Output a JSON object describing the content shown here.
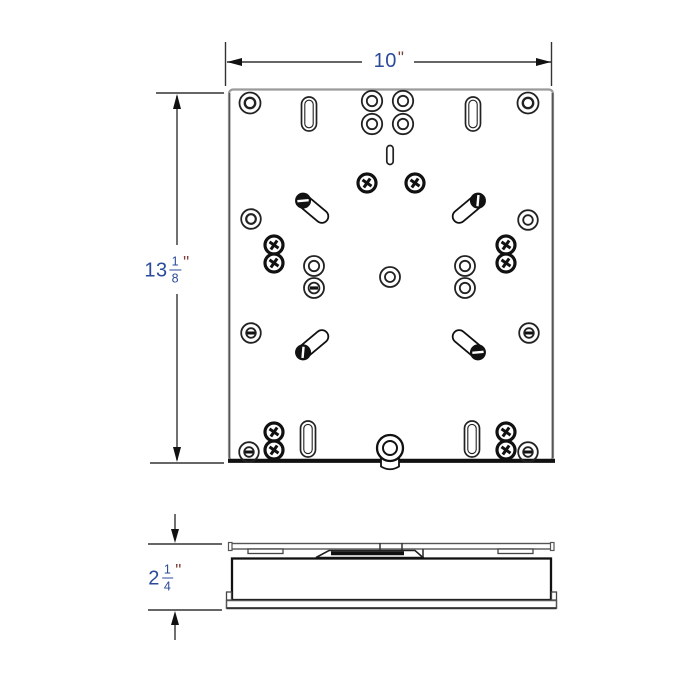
{
  "drawing": {
    "type": "technical-dimension-drawing",
    "subject": "flat mounting plate shown in top view and side profile view",
    "dimensions": {
      "width": {
        "value": "10",
        "unit": "\""
      },
      "height": {
        "whole": "13",
        "numerator": "1",
        "denominator": "8",
        "unit": "\""
      },
      "thickness": {
        "whole": "2",
        "numerator": "1",
        "denominator": "4",
        "unit": "\""
      }
    },
    "feature_glyphs": [
      "washer-hole",
      "slotted-screw-hole",
      "phillips-screw",
      "vertical-mounting-slot",
      "diagonal-adjustment-slot",
      "small-center-slot",
      "center-bolt"
    ],
    "colors": {
      "dimension_number": "#2b4a9c",
      "unit_mark": "#7c4038",
      "linework": "#333333",
      "heavy_line": "#111111",
      "light_edge": "#9a9a9a",
      "background": "#ffffff"
    }
  }
}
